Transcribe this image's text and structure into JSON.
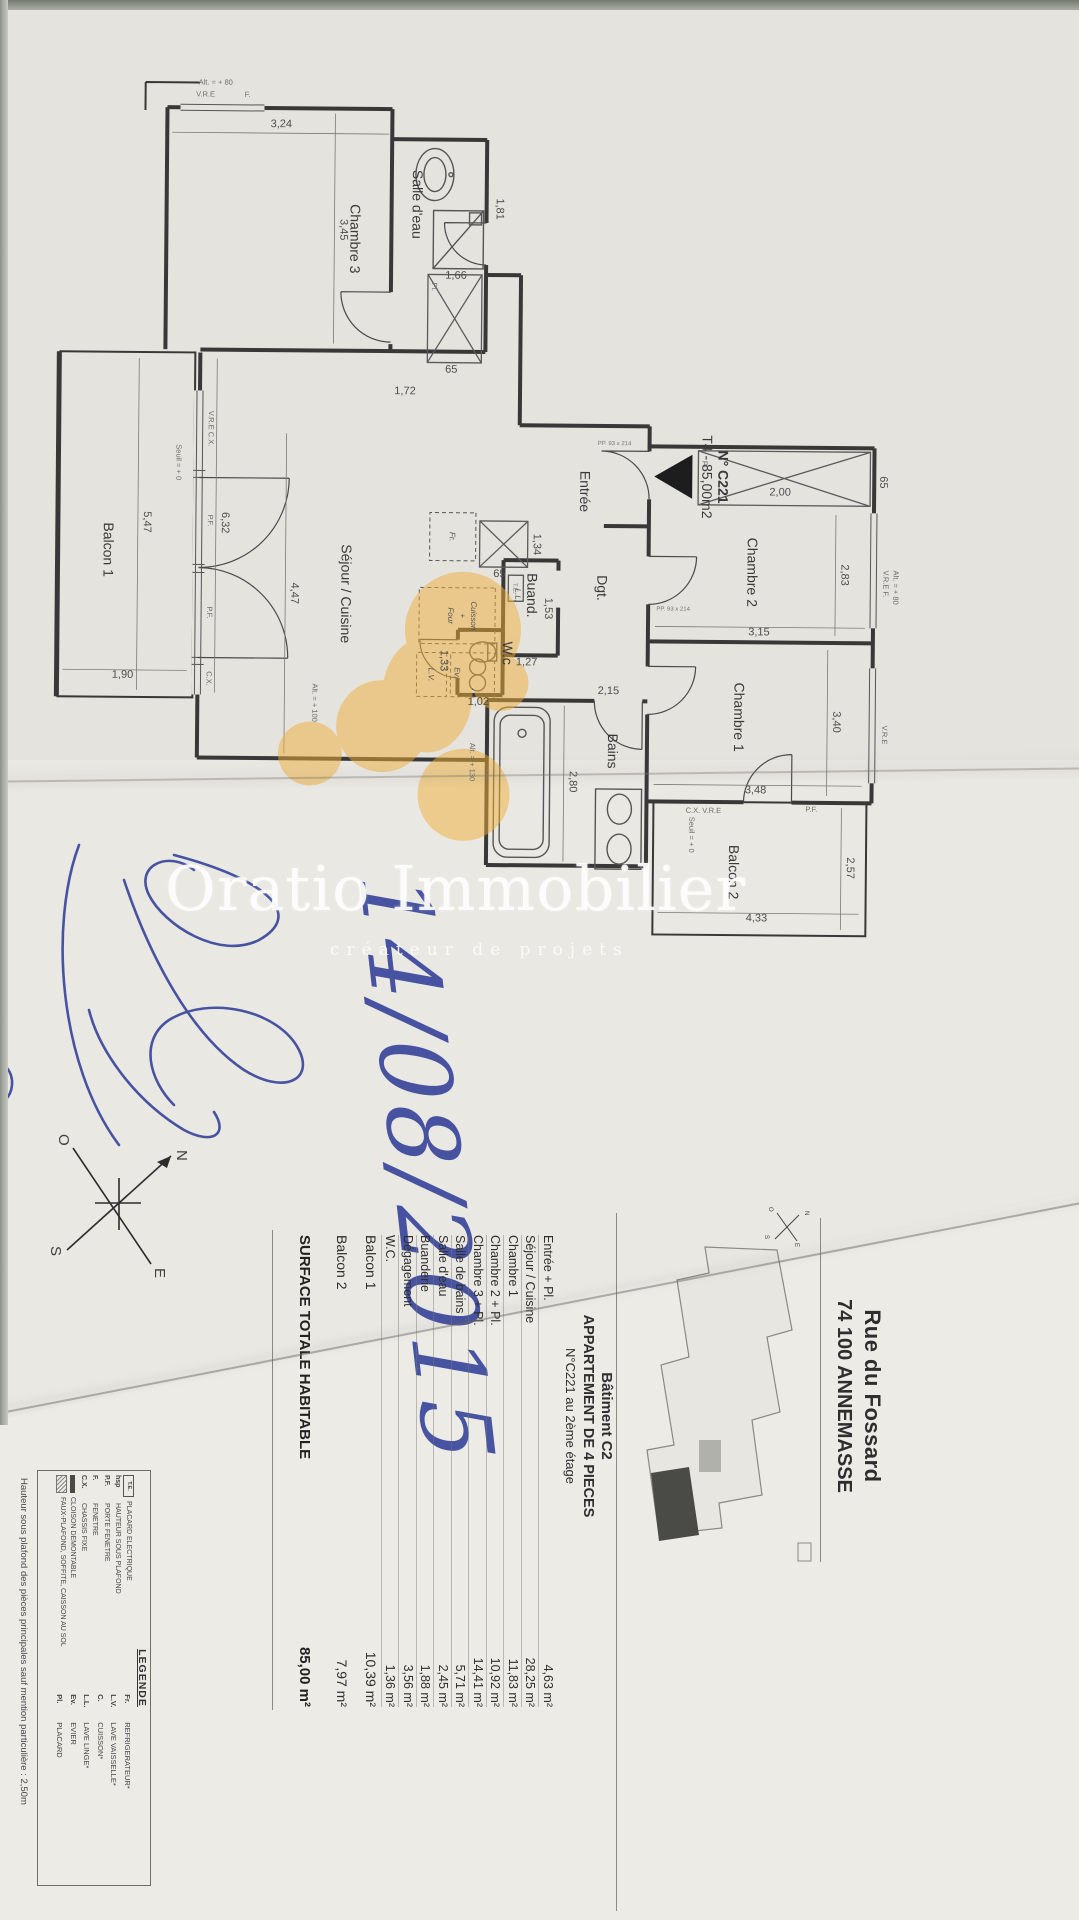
{
  "colors": {
    "highlight": "#EFAF3A",
    "ink_blue": "#2B3A96",
    "wall": "#383838"
  },
  "watermark": {
    "brand": "Oratio Immobilier",
    "tagline": "créateur de projets"
  },
  "handwriting": {
    "date": "14/08/2015"
  },
  "plan": {
    "title": {
      "ref": "N° C221",
      "type": "T4 - 85,00m2"
    },
    "rooms": {
      "entree": "Entrée",
      "sejour": "Séjour / Cuisine",
      "chambre1": "Chambre 1",
      "chambre2": "Chambre 2",
      "chambre3": "Chambre 3",
      "salle_eau": "Salle d'eau",
      "bains": "Bains",
      "buanderie": "Buand.",
      "dgt": "Dgt.",
      "wc": "W.c",
      "balcon1": "Balcon 1",
      "balcon2": "Balcon 2"
    },
    "kitchen": {
      "fr": "Fr.",
      "cuisson": "Cuisson",
      "plus": "+",
      "four": "Four",
      "ev": "Ev.",
      "lv": "L.V.",
      "ll": "L.L.",
      "te": "T.E."
    },
    "dims": {
      "d3_24": "3,24",
      "d3_45": "3,45",
      "d1_81": "1,81",
      "d1_66": "1,66",
      "d1_72": "1,72",
      "d65": "65",
      "d6_32": "6,32",
      "d5_47": "5,47",
      "d1_90": "1,90",
      "d4_47": "4,47",
      "d1_34": "1,34",
      "d1_53": "1,53",
      "d1_27": "1,27",
      "d1_02": "1,02",
      "d1_33": "1,33",
      "d2_00": "2,00",
      "d2_83": "2,83",
      "d3_15": "3,15",
      "d3_40": "3,40",
      "d3_48": "3,48",
      "d2_15": "2,15",
      "d2_80": "2,80",
      "d2_57": "2,57",
      "d4_33": "4,33"
    },
    "marks": {
      "seuil": "Seuil = + 0",
      "alt80": "Alt. = + 80",
      "alt100": "Alt. = + 100",
      "alt130": "Alt. = + 130",
      "vre": "V.R.E",
      "vre_f": "V.R.E F.",
      "cx": "C.X.",
      "pf": "P.F.",
      "f": "F.",
      "cx_vre": "C.X. V.R.E",
      "vre_cx": "V.R.E C.X.",
      "pl": "Pl.",
      "door": "PP. 93 x 214"
    },
    "compass": {
      "n": "N",
      "s": "S",
      "e": "E",
      "o": "O"
    }
  },
  "title_block": {
    "address1": "Rue du Fossard",
    "address2": "74 100 ANNEMASSE",
    "building": "Bâtiment C2",
    "apartment": "APPARTEMENT DE 4 PIECES",
    "unit": "N°C221 au 2ème étage",
    "table": {
      "rows": [
        {
          "name": "Entrée + Pl.",
          "area": "4,63 m²"
        },
        {
          "name": "Séjour / Cuisine",
          "area": "28,25 m²"
        },
        {
          "name": "Chambre 1",
          "area": "11,83 m²"
        },
        {
          "name": "Chambre 2 + Pl.",
          "area": "10,92 m²"
        },
        {
          "name": "Chambre 3 + Pl.",
          "area": "14,41 m²"
        },
        {
          "name": "Salle de bains",
          "area": "5,71 m²"
        },
        {
          "name": "Salle d'eau",
          "area": "2,45 m²"
        },
        {
          "name": "Buanderie",
          "area": "1,88 m²"
        },
        {
          "name": "Dégagement",
          "area": "3,56 m²"
        },
        {
          "name": "W.C.",
          "area": "1,36 m²"
        }
      ]
    },
    "balconies": [
      {
        "name": "Balcon 1",
        "area": "10,39 m²"
      },
      {
        "name": "Balcon 2",
        "area": "7,97 m²"
      }
    ],
    "total": {
      "label": "SURFACE TOTALE HABITABLE",
      "area": "85,00 m²"
    },
    "ceiling_note": "Hauteur sous plafond des pièces principales sauf mention particulière : 2,50m",
    "legend": {
      "title": "LEGENDE",
      "left": [
        {
          "abbr": "T.E.",
          "label": "PLACARD ELECTRIQUE"
        },
        {
          "abbr": "hsp",
          "label": "HAUTEUR SOUS PLAFOND"
        },
        {
          "abbr": "P.F.",
          "label": "PORTE FENETRE"
        },
        {
          "abbr": "F.",
          "label": "FENETRE"
        },
        {
          "abbr": "C.X.",
          "label": "CHASSIS FIXE"
        },
        {
          "abbr": "",
          "label": "CLOISON DEMONTABLE"
        },
        {
          "abbr": "",
          "label": "FAUX-PLAFOND, SOFFITE, CAISSON AU SOL"
        }
      ],
      "right": [
        {
          "abbr": "Fr.",
          "label": "REFRIGERATEUR*"
        },
        {
          "abbr": "L.V.",
          "label": "LAVE VAISSELLE*"
        },
        {
          "abbr": "C.",
          "label": "CUISSON*"
        },
        {
          "abbr": "L.L.",
          "label": "LAVE LINGE*"
        },
        {
          "abbr": "Ev.",
          "label": "EVIER"
        },
        {
          "abbr": "Pl.",
          "label": "PLACARD"
        }
      ]
    }
  }
}
